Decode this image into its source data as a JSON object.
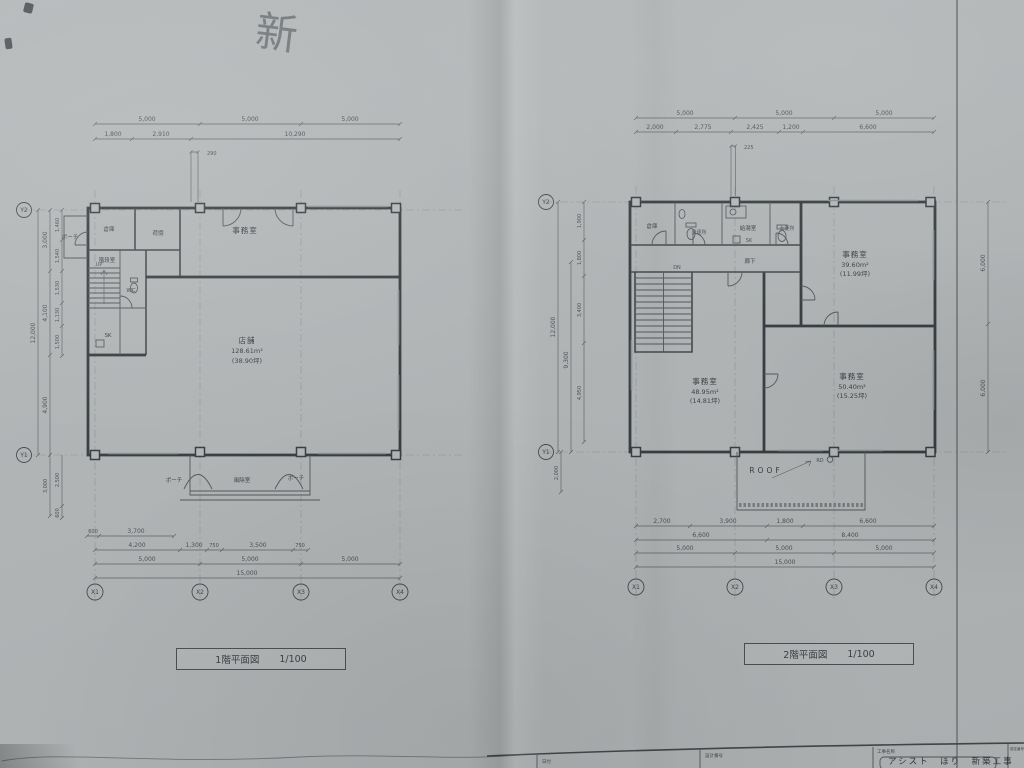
{
  "photo": {
    "handwriting": "新"
  },
  "captions": {
    "floor1": {
      "title": "1階平面図",
      "scale": "1/100"
    },
    "floor2": {
      "title": "2階平面図",
      "scale": "1/100"
    }
  },
  "title_block": {
    "date_label": "日付",
    "design_no_label": "設計番号",
    "project_label": "工事名称",
    "project_name": "アシスト　ほり　新築工事",
    "cert_label": "認定番号"
  },
  "floor1": {
    "axes": {
      "x": [
        "X1",
        "X2",
        "X3",
        "X4"
      ],
      "y": [
        "Y2",
        "Y1"
      ]
    },
    "rooms": {
      "porch_side": "ポーチ",
      "storage": "倉庫",
      "loading": "荷捌",
      "office": "事務室",
      "stair_room": "階段室",
      "up": "UP",
      "wc": "WC",
      "sk": "SK",
      "shop": "店舗",
      "shop_area": "128.61m²",
      "shop_tsubo": "(38.90坪)",
      "windbreak": "風除室",
      "porch_left": "ポーチ",
      "porch_right": "ポーチ"
    },
    "dims": {
      "top1": [
        "5,000",
        "5,000",
        "5,000"
      ],
      "top2": [
        "1,800",
        "2,910",
        "10,290"
      ],
      "top3": "290",
      "left_outer": "12,000",
      "left_mid": [
        "3,000",
        "4,100",
        "4,900"
      ],
      "left_inner": [
        "1,460",
        "1,540",
        "1,530",
        "1,130",
        "1,500"
      ],
      "left_lower": [
        "3,000",
        "2,500",
        "600"
      ],
      "bottom1": [
        "600",
        "3,700"
      ],
      "bottom2": [
        "4,200",
        "1,300",
        "750",
        "3,500",
        "750"
      ],
      "bottom3": [
        "5,000",
        "5,000",
        "5,000"
      ],
      "bottom4": "15,000"
    }
  },
  "floor2": {
    "axes": {
      "x": [
        "X1",
        "X2",
        "X3",
        "X4"
      ],
      "y": [
        "Y2",
        "Y1"
      ]
    },
    "rooms": {
      "storage": "倉庫",
      "men_wc": "男便所",
      "kitchenette": "給湯室",
      "sk": "SK",
      "women_wc": "女便所",
      "corridor": "廊下",
      "dn": "DN",
      "office1": "事務室",
      "office1_area": "39.60m²",
      "office1_tsubo": "(11.99坪)",
      "office2": "事務室",
      "office2_area": "48.95m²",
      "office2_tsubo": "(14.81坪)",
      "office3": "事務室",
      "office3_area": "50.40m²",
      "office3_tsubo": "(15.25坪)",
      "roof": "ROOF",
      "rd": "RD"
    },
    "dims": {
      "top1": [
        "5,000",
        "5,000",
        "5,000"
      ],
      "top2": [
        "2,000",
        "2,775",
        "2,425",
        "1,200",
        "6,600"
      ],
      "top3": "225",
      "left_outer": "12,000",
      "left_mid": "9,300",
      "left_inner": [
        "1,900",
        "1,800",
        "3,400",
        "4,950"
      ],
      "left_below": "2,000",
      "right": [
        "6,000",
        "6,000"
      ],
      "bottom1": [
        "2,700",
        "3,900",
        "1,800",
        "6,600"
      ],
      "bottom2": [
        "6,600",
        "8,400"
      ],
      "bottom3": [
        "5,000",
        "5,000",
        "5,000"
      ],
      "bottom4": "15,000"
    }
  }
}
